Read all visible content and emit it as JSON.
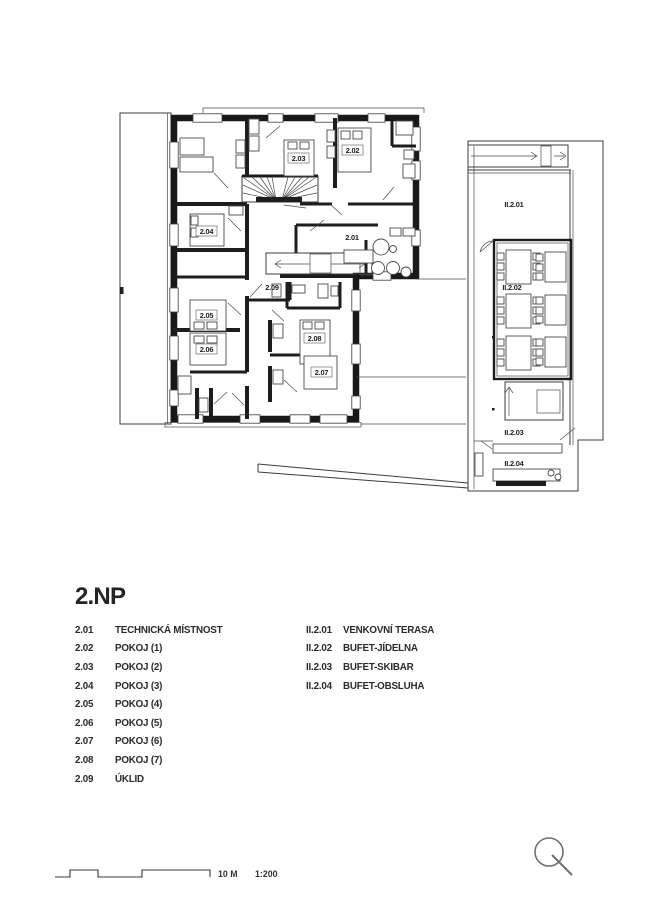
{
  "title": "2.NP",
  "legend": {
    "left": [
      {
        "code": "2.01",
        "name": "TECHNICKÁ MÍSTNOST"
      },
      {
        "code": "2.02",
        "name": "POKOJ (1)"
      },
      {
        "code": "2.03",
        "name": "POKOJ (2)"
      },
      {
        "code": "2.04",
        "name": "POKOJ (3)"
      },
      {
        "code": "2.05",
        "name": "POKOJ (4)"
      },
      {
        "code": "2.06",
        "name": "POKOJ (5)"
      },
      {
        "code": "2.07",
        "name": "POKOJ (6)"
      },
      {
        "code": "2.08",
        "name": "POKOJ (7)"
      },
      {
        "code": "2.09",
        "name": "ÚKLID"
      }
    ],
    "right": [
      {
        "code": "II.2.01",
        "name": "VENKOVNÍ TERASA"
      },
      {
        "code": "II.2.02",
        "name": "BUFET-JÍDELNA"
      },
      {
        "code": "II.2.03",
        "name": "BUFET-SKIBAR"
      },
      {
        "code": "II.2.04",
        "name": "BUFET-OBSLUHA"
      }
    ]
  },
  "plan": {
    "main_rooms": {
      "r201": "2.01",
      "r202": "2.02",
      "r203": "2.03",
      "r204": "2.04",
      "r205": "2.05",
      "r206": "2.06",
      "r207": "2.07",
      "r208": "2.08",
      "r209": "2.09"
    },
    "annex_rooms": {
      "t201": "II.2.01",
      "t202": "II.2.02",
      "t203": "II.2.03",
      "t204": "II.2.04"
    }
  },
  "scalebar": {
    "length": "10 M",
    "ratio": "1:200"
  },
  "colors": {
    "ink": "#1d1d1d",
    "paper": "#ffffff"
  }
}
